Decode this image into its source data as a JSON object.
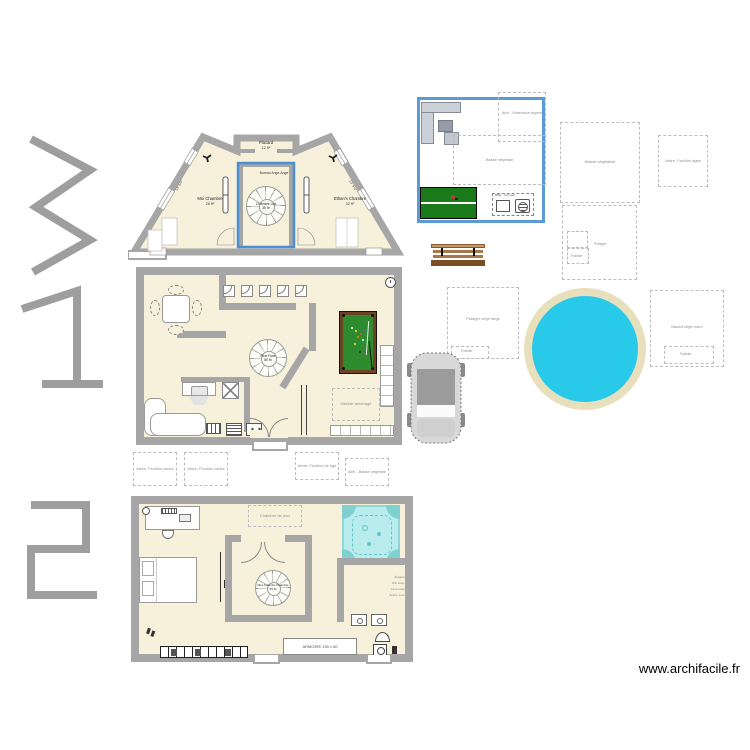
{
  "watermark": "www.archifacile.fr",
  "floor_numbers": {
    "top": "3",
    "middle": "1",
    "bottom": "2"
  },
  "colors": {
    "selection_blue": "#5b9bd5",
    "wall_gray": "#a6a6a6",
    "floor_cream": "#f7f1dc",
    "pool_water": "#29c9ea",
    "pool_deck": "#e8dfbc",
    "billiard_green": "#2e8b2e",
    "pingpong_green": "#1a7a1a",
    "jacuzzi_cyan": "#b9ecec",
    "numeral_gray": "#9e9e9e"
  },
  "icons": {
    "stair": "spiral-staircase",
    "fan": "ceiling-fan",
    "clock": "wall-clock",
    "bbq": "barbecue-grill",
    "washer": "washing-machine"
  },
  "floor3": {
    "placard": "Placard",
    "placard_area": "12 ft²",
    "left_room": "Moi Chambre",
    "left_area": "28 ft²",
    "right_room": "Ethan's Chambre",
    "right_area": "32 ft²",
    "note": "Bureau Ange-Ange",
    "stair_name": "Chambre Léa",
    "stair_area": "35 ft²",
    "dim_left": "13' 5⅞″",
    "dim_right": "13' 5⅞″"
  },
  "floor1": {
    "stair_name": "First Floor",
    "stair_area": "85 ft²",
    "ghost_label": "Meuble aménagé"
  },
  "floor2": {
    "stair_name": "Mes Parents Chambre",
    "stair_area": "55 ft²",
    "ghost_label": "Chambre de jeux",
    "cabinet_label": "ARMOIRE  155 x 60",
    "bath_notes": [
      "Étagère",
      "WC susp.",
      "Lave-main",
      "Sèche-serv."
    ]
  },
  "terrace": {
    "shelter_label": "Abri - Extension légère",
    "bed_label": "Basse végétale",
    "bbq_label": "BBQ - Grill gaz"
  },
  "garden": {
    "ghosts": [
      {
        "label": "Massif végétalisé"
      },
      {
        "label": "Arbre, Feuillus âgés"
      },
      {
        "label": "Potager",
        "sub": "Fraisier"
      },
      {
        "label": "Massif végé mûre",
        "sub": "Fraisier"
      },
      {
        "label": "Potager végé large",
        "sub": "Fraisier"
      },
      {
        "label": "Arbre, Feuillus caduc"
      },
      {
        "label": "Arbre, Feuillus caduc"
      },
      {
        "label": "Arbre, Feuillus de tige"
      },
      {
        "label": "Abri - Basse végétale"
      }
    ]
  }
}
